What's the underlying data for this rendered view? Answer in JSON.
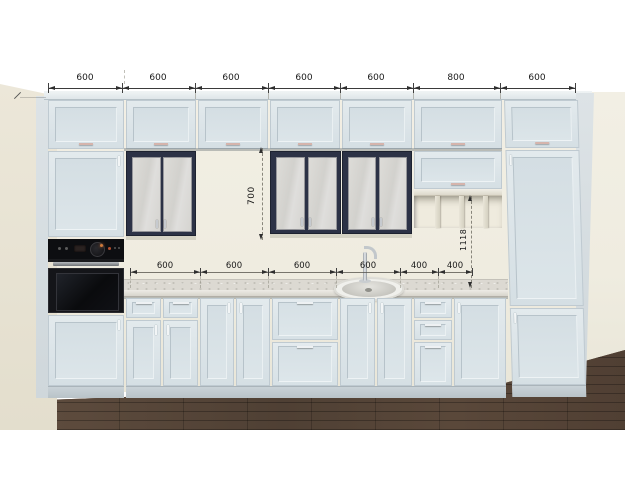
{
  "scene": {
    "type": "kitchen-front-elevation-render",
    "units": "mm"
  },
  "dimensions": {
    "top_row": [
      "600",
      "600",
      "600",
      "600",
      "600",
      "800",
      "600"
    ],
    "mid_row": [
      "600",
      "600",
      "600",
      "600",
      "400",
      "400"
    ],
    "vertical": [
      "700",
      "1118"
    ]
  },
  "colors": {
    "cabinet_light": "#dce5e9",
    "cabinet_dark_frame": "#2c3246",
    "glass_pane": "#d8d7d2",
    "countertop": "#dcd9d2",
    "backsplash_wall": "#f1eee3",
    "side_wall": "#ebe6d8",
    "floor_wood": "#57463a",
    "oven_black": "#0d0e11",
    "dimension_text": "#181818",
    "handle_accent": "#d5b4ac"
  }
}
